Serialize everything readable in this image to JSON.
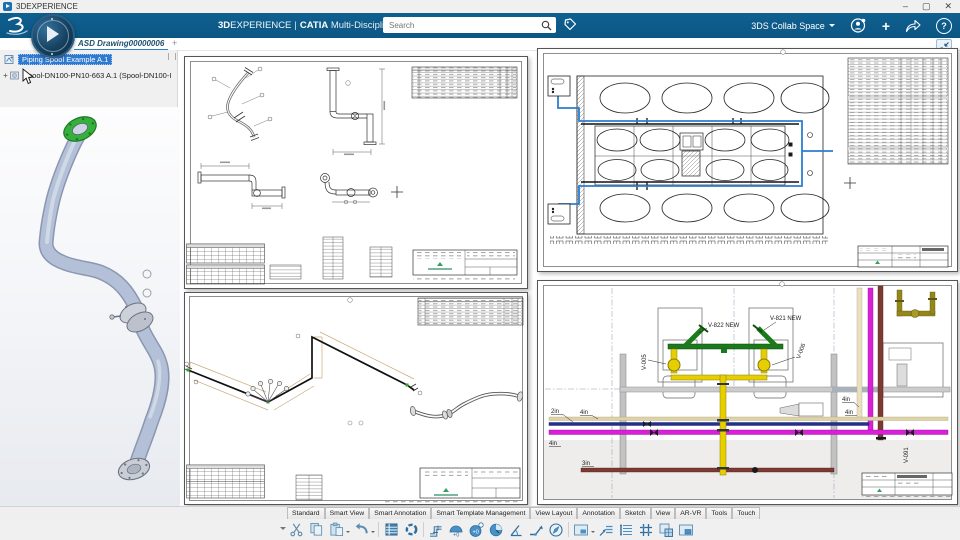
{
  "window": {
    "title": "3DEXPERIENCE",
    "minimize": "–",
    "maximize": "▢",
    "close": "✕"
  },
  "ribbon": {
    "brand_bold": "3D",
    "brand_light": "EXPERIENCE",
    "divider": "|",
    "app_name": "CATIA",
    "app_module": "Multi-Discipline Drafting",
    "search_placeholder": "Search",
    "collab_space_label": "3DS Collab Space",
    "add_label": "+",
    "help_label": "?"
  },
  "document_tabs": {
    "active": "ASD Drawing00000006",
    "add_tab": "+"
  },
  "tree": {
    "expander": "+",
    "items": [
      {
        "label": "Piping Spool Example A.1"
      },
      {
        "label": "Spool-DN100-PN10-663 A.1 (Spool-DN100-I"
      }
    ]
  },
  "sheet_d": {
    "labels": {
      "v822": "V-822 NEW",
      "v821": "V-821 NEW",
      "v005": "V-005",
      "v006": "V-006",
      "v091": "V-091",
      "size_2in": "2in",
      "size_4in_left": "4in",
      "size_4in_right_top": "4in",
      "size_4in_right_bottom": "4in",
      "size_4in_low_left": "4in",
      "size_3in": "3in"
    }
  },
  "bottom_tabs": [
    "Standard",
    "Smart View",
    "Smart Annotation",
    "Smart Template Management",
    "View Layout",
    "Annotation",
    "Sketch",
    "View",
    "AR-VR",
    "Tools",
    "Touch"
  ],
  "toolbar": {
    "weld_plus_label": "+0",
    "icons": [
      "overflow-chevron",
      "cut",
      "copy",
      "paste",
      "undo",
      "sheet-table",
      "update",
      "pipe-fitting",
      "weld-add",
      "weld-node",
      "pie-view",
      "angle-dimension",
      "bend-dimension",
      "compass",
      "view-frame",
      "leader-note",
      "text-lines",
      "grid",
      "new-sheet",
      "embed-sheet"
    ]
  },
  "colors": {
    "ribbon_blue": "#0d5c8d",
    "accent_blue": "#2f7fbf",
    "selection_blue": "#2f7ad1",
    "pipe_green": "#1c7a1c",
    "pipe_yellow": "#e6cf00",
    "pipe_magenta": "#d91fd9",
    "pipe_navy": "#23308f",
    "pipe_brown": "#7d3a32",
    "pipe_olive": "#948618",
    "route_blue": "#2b7fd0",
    "flange_green": "#35b03c"
  }
}
